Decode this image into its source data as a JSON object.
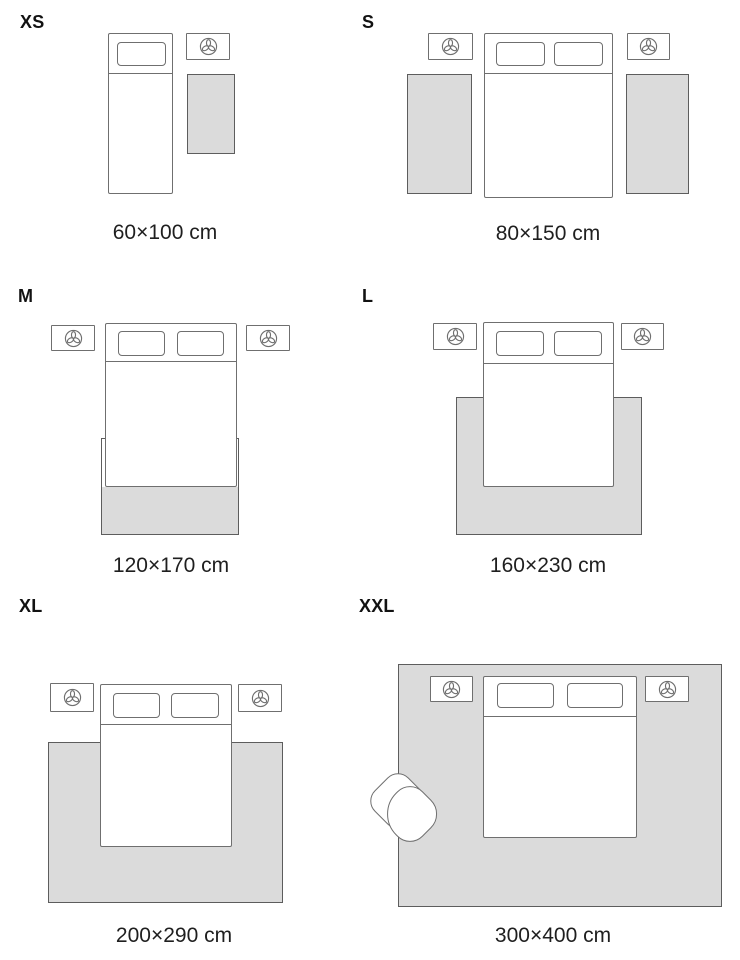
{
  "title": "Rug size guide",
  "colors": {
    "background": "#ffffff",
    "rug_fill": "#dbdbdb",
    "rug_border": "#5d5d5d",
    "furniture_border": "#6f6f6f",
    "text": "#1f1f1f"
  },
  "icons": {
    "nightstand_icon": "plant-icon"
  },
  "panels": [
    {
      "label": "XS",
      "caption": "60×100 cm"
    },
    {
      "label": "S",
      "caption": "80×150 cm"
    },
    {
      "label": "M",
      "caption": "120×170 cm"
    },
    {
      "label": "L",
      "caption": "160×230 cm"
    },
    {
      "label": "XL",
      "caption": "200×290 cm"
    },
    {
      "label": "XXL",
      "caption": "300×400 cm"
    }
  ]
}
